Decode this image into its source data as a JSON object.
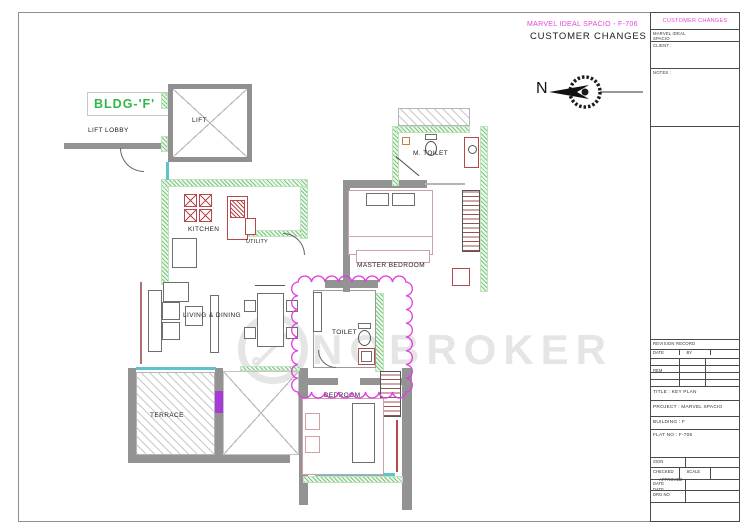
{
  "annotations": {
    "project_line": "MARVEL IDEAL SPACIO - F-706",
    "change_line": "CUSTOMER CHANGES",
    "north": "N",
    "watermark": "NOBROKER"
  },
  "plan": {
    "bldg": "BLDG-'F'",
    "lift_lobby": "LIFT LOBBY",
    "lift": "LIFT",
    "kitchen": "KITCHEN",
    "utility": "UTILITY",
    "m_toilet": "M. TOILET",
    "master_bedroom": "MASTER BEDROOM",
    "living_dining": "LIVING & DINING",
    "toilet": "TOILET",
    "bedroom": "BEDROOM",
    "terrace": "TERRACE"
  },
  "title_block": {
    "header": "CUSTOMER CHANGES",
    "r2a": "MARVEL IDEAL",
    "r2b": "SPACIO",
    "client_label": "CLIENT :",
    "notes_label": "NOTES :",
    "rev_title": "REVISION RECORD",
    "rev_cols": [
      "DATE",
      "BY",
      "REM"
    ],
    "title_row": "TITLE :  KEY PLAN",
    "project_row": "PROJECT :  MARVEL SPACIO",
    "building_row": "BUILDING :  F",
    "flat_row": "FLAT NO :  F-706",
    "b1a": "SIGN",
    "b1b": "APPROVED",
    "b2a": "CHECKED",
    "b2b": "SCALE",
    "b2c": "DATE",
    "b3a": "DATE",
    "b4a": "DRG NO"
  },
  "colors": {
    "revision_magenta": "#e03ce0",
    "wall_green": "#7cc87c",
    "bldg_green": "#2eb84a",
    "fixture_red": "#b54848",
    "wall_gray": "#939393",
    "window_cyan": "#5ec2cf"
  }
}
